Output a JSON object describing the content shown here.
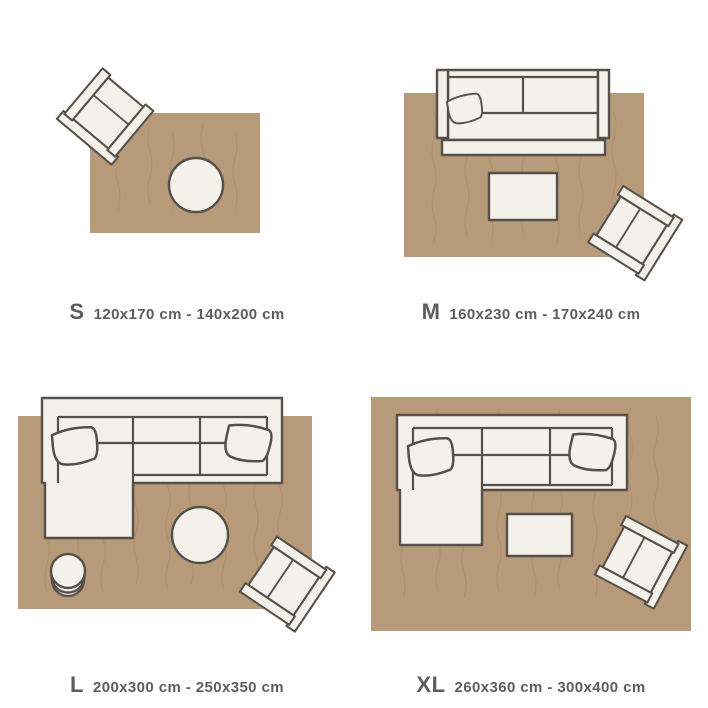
{
  "colors": {
    "background": "#ffffff",
    "rug": "#b79a79",
    "rug_texture": "#a5875f",
    "outline": "#55514a",
    "furniture": "#f4f1ea",
    "text": "#5d5d5f"
  },
  "sizes": [
    {
      "letter": "S",
      "range": "120x170 cm - 140x200 cm",
      "furniture": [
        "armchair",
        "round-coffee-table"
      ]
    },
    {
      "letter": "M",
      "range": "160x230 cm - 170x240 cm",
      "furniture": [
        "two-seat-sofa",
        "cushion",
        "coffee-table",
        "armchair"
      ]
    },
    {
      "letter": "L",
      "range": "200x300 cm - 250x350 cm",
      "furniture": [
        "corner-sofa",
        "cushion",
        "cushion",
        "round-coffee-table",
        "side-table",
        "armchair"
      ]
    },
    {
      "letter": "XL",
      "range": "260x360 cm - 300x400 cm",
      "furniture": [
        "corner-sofa",
        "cushion",
        "cushion",
        "coffee-table",
        "armchair"
      ]
    }
  ]
}
